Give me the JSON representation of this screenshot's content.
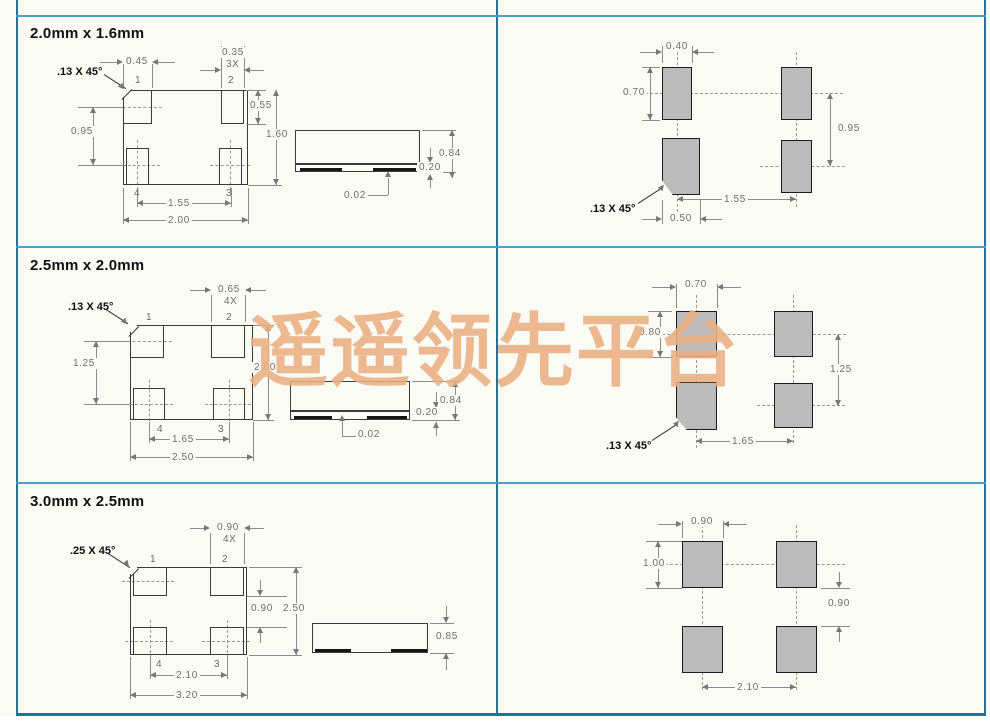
{
  "watermark": "遥遥领先平台",
  "colors": {
    "border_dark": "#2d6f92",
    "border_light": "#4aa0d2",
    "watermark_orange": "#eaaf81",
    "land_pad_gray": "#bbbbbb",
    "background": "#fbfbf6"
  },
  "sections": [
    {
      "title": "2.0mm x 1.6mm",
      "package": {
        "chamfer": ".13 X 45°",
        "pad1_width": "0.45",
        "pad_width": "0.35",
        "pad_width_count": "3X",
        "pin1": "1",
        "pin2": "2",
        "pin3": "3",
        "pin4": "4",
        "row_pitch": "0.95",
        "pad_height": "0.55",
        "body_height": "1.60",
        "col_pitch": "1.55",
        "body_width": "2.00"
      },
      "side_view": {
        "height": "0.84",
        "base_height": "0.20",
        "standoff": "0.02"
      },
      "land_pattern": {
        "pad_width": "0.40",
        "pad_height": "0.70",
        "row_pitch": "0.95",
        "col_pitch": "1.55",
        "pad1_width": "0.50",
        "chamfer": ".13 X 45°"
      }
    },
    {
      "title": "2.5mm x 2.0mm",
      "package": {
        "chamfer": ".13 X 45°",
        "pad_width": "0.65",
        "pad_width_count": "4X",
        "pin1": "1",
        "pin2": "2",
        "pin3": "3",
        "pin4": "4",
        "row_pitch": "1.25",
        "body_height": "2.00",
        "col_pitch": "1.65",
        "body_width": "2.50"
      },
      "side_view": {
        "height": "0.84",
        "base_height": "0.20",
        "standoff": "0.02"
      },
      "land_pattern": {
        "pad_width": "0.70",
        "pad_height": "0.80",
        "row_pitch": "1.25",
        "col_pitch": "1.65",
        "chamfer": ".13 X 45°"
      }
    },
    {
      "title": "3.0mm x 2.5mm",
      "package": {
        "chamfer": ".25 X 45°",
        "pad_width": "0.90",
        "pad_width_count": "4X",
        "pin1": "1",
        "pin2": "2",
        "pin3": "3",
        "pin4": "4",
        "row_gap": "0.90",
        "body_height": "2.50",
        "col_pitch": "2.10",
        "body_width": "3.20"
      },
      "side_view": {
        "height": "0.85"
      },
      "land_pattern": {
        "pad_width": "0.90",
        "pad_height": "1.00",
        "row_gap": "0.90",
        "col_pitch": "2.10"
      }
    }
  ]
}
